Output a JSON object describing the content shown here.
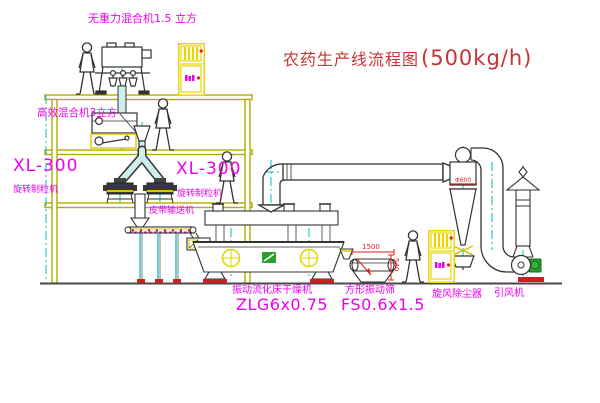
{
  "title": {
    "text": "农药生产线流程图",
    "capacity": "(500kg/h)"
  },
  "labels": {
    "gravity_free_mixer": "无重力混合机1.5 立方",
    "high_eff_mixer": "高效混合机3立方",
    "xl_left_model": "XL-300",
    "xl_left_name": "旋转制粒机",
    "xl_right_model": "XL-300",
    "xl_right_name": "旋转制粒机",
    "belt_conveyor": "皮带输送机",
    "dryer_name": "振动流化床干燥机",
    "dryer_model": "ZLG6x0.75",
    "sieve_name": "方形振动筛",
    "sieve_model": "FS0.6x1.5",
    "cyclone": "旋风除尘器",
    "fan": "引风机"
  },
  "dimensions": {
    "sieve_length": "1500",
    "sieve_height": "540",
    "cyclone_mark": "Φ600"
  },
  "colors": {
    "label_magenta": "#ee00ee",
    "title_red": "#c83232",
    "structure_olive": "#b0ac00",
    "centerline_cyan": "#00c0c0",
    "cabinet_yellow": "#e8d400",
    "dimension_red": "#dd2222",
    "machine_line": "#333333",
    "accent_red": "#cc2020",
    "accent_green": "#2e9e2e"
  }
}
